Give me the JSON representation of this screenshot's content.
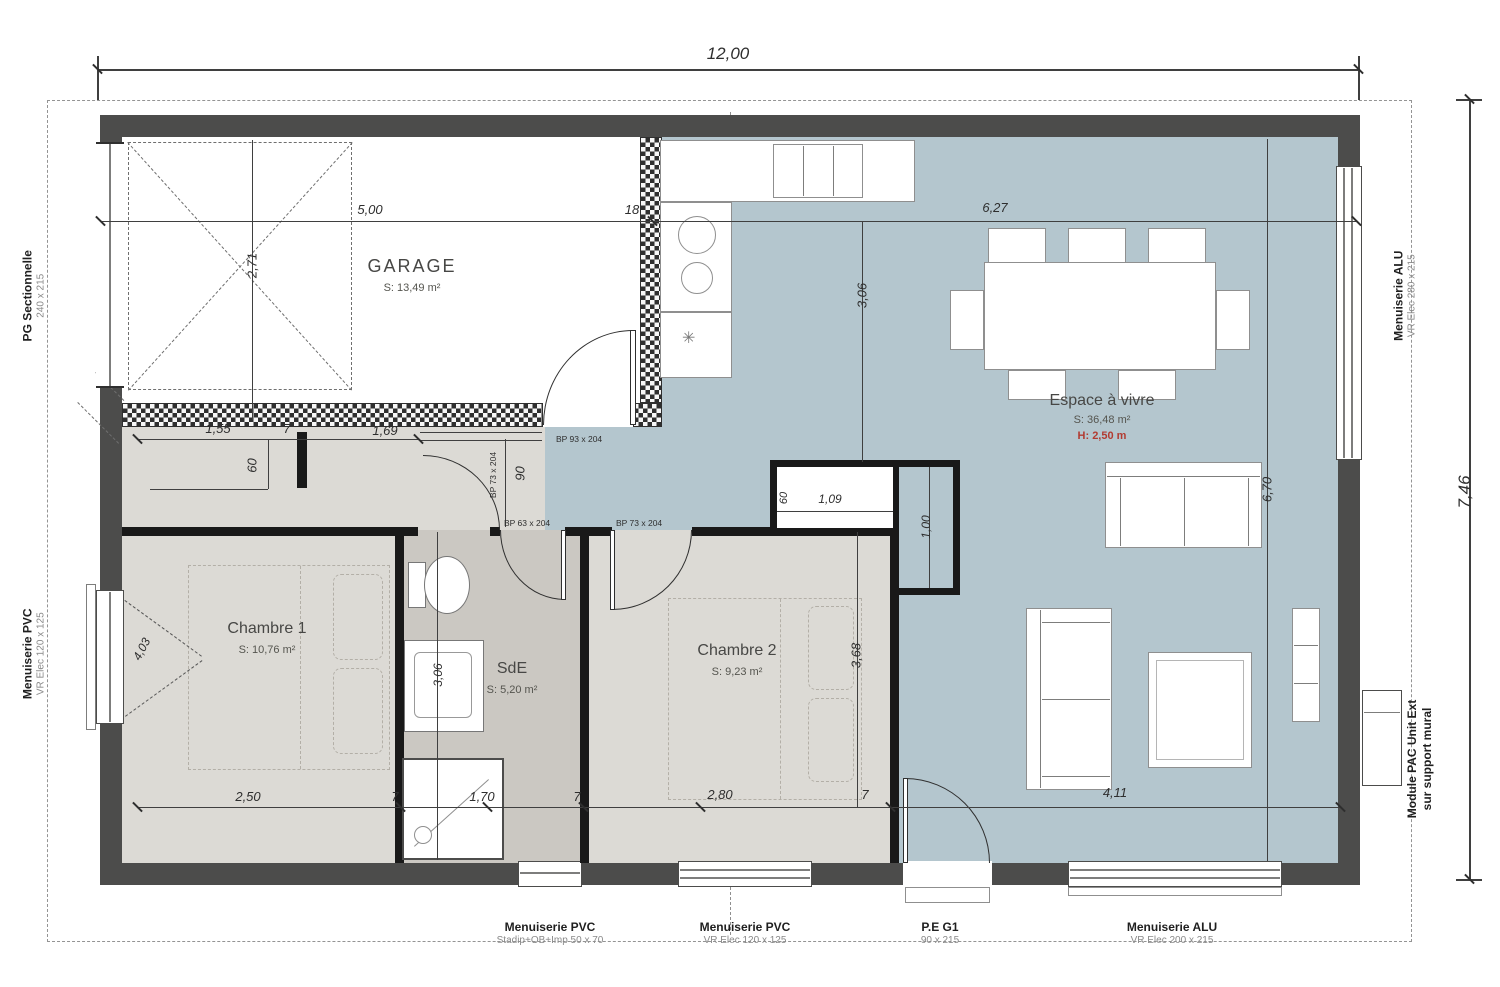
{
  "plan": {
    "rooms": {
      "garage": {
        "name": "GARAGE",
        "area": "S: 13,49 m²"
      },
      "chambre1": {
        "name": "Chambre 1",
        "area": "S: 10,76 m²"
      },
      "sde": {
        "name": "SdE",
        "area": "S: 5,20 m²"
      },
      "chambre2": {
        "name": "Chambre 2",
        "area": "S: 9,23 m²"
      },
      "espace": {
        "name": "Espace à vivre",
        "area": "S: 36,48 m²",
        "height": "H: 2,50 m"
      }
    },
    "dims": {
      "overall_width": "12,00",
      "overall_height": "7,46",
      "garage_width": "5,00",
      "wall_thickness": "18",
      "living_width": "6,27",
      "garage_depth": "2,71",
      "kitchen_depth": "3,06",
      "hall_a": "1,55",
      "hall_b": "7",
      "hall_c": "1,69",
      "hall_d": "60",
      "door_w": "90",
      "placard_d": "60",
      "placard_w": "1,09",
      "placard_h": "1,00",
      "ch1_w": "2,50",
      "s1": "7",
      "sde_w": "1,70",
      "s2": "7",
      "ch2_w": "2,80",
      "s3": "7",
      "living_b": "4,11",
      "ch1_diag": "4,03",
      "sde_d": "3,06",
      "ch2_d": "3,68",
      "living_d": "6,70"
    },
    "door_labels": {
      "bp93": "BP 93 x 204",
      "bp73_v": "BP 73 x 204",
      "bp63": "BP 63 x 204",
      "bp73_h": "BP 73 x 204"
    },
    "openings": {
      "left_top": {
        "title": "PG Sectionnelle",
        "size": "240 x 215"
      },
      "left_bottom": {
        "title": "Menuiserie PVC",
        "size": "VR Elec 120 x 125"
      },
      "right_top": {
        "title": "Menuiserie ALU",
        "size": "VR Elec 280 x 215"
      },
      "right_bottom": {
        "title": "Module PAC Unit Ext",
        "size": "sur support mural"
      },
      "bottom_1": {
        "title": "Menuiserie PVC",
        "size": "Stadip+OB+Imp 50 x 70"
      },
      "bottom_2": {
        "title": "Menuiserie PVC",
        "size": "VR Elec 120 x 125"
      },
      "bottom_3": {
        "title": "P.E G1",
        "size": "90 x 215"
      },
      "bottom_4": {
        "title": "Menuiserie ALU",
        "size": "VR Elec 200 x 215"
      }
    },
    "colors": {
      "living_floor": "#b4c6ce",
      "room_floor": "#dcdad5",
      "sde_floor": "#cbc8c2",
      "wall": "#4c4c4b",
      "accent_red": "#b23b31"
    }
  }
}
